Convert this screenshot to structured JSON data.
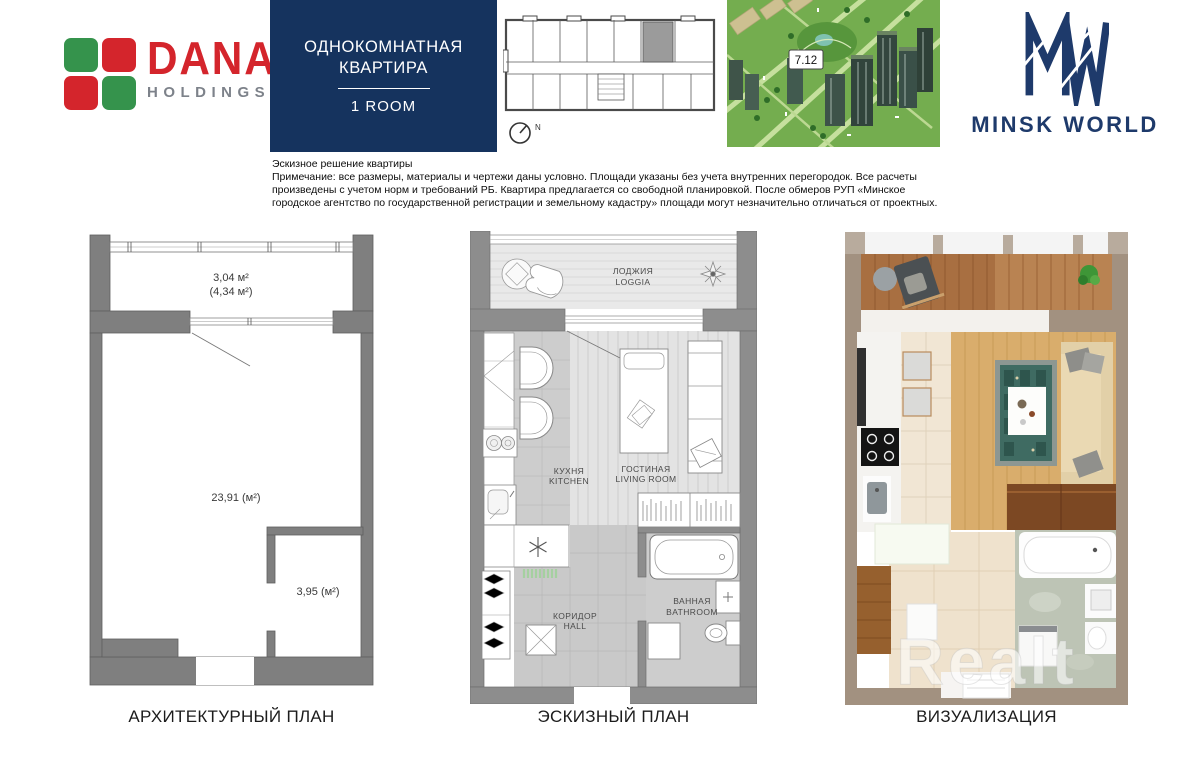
{
  "header": {
    "dana": {
      "name": "DANA",
      "subtitle": "HOLDINGS"
    },
    "title_box": {
      "line1": "ОДНОКОМНАТНАЯ",
      "line2": "КВАРТИРА",
      "room": "1 ROOM"
    },
    "compass_label": "N",
    "map_label": "7.12",
    "minsk_world": "MINSK WORLD"
  },
  "disclaimer": {
    "title": "Эскизное решение квартиры",
    "body": "Примечание: все размеры, материалы и чертежи даны условно. Площади указаны без учета внутренних перегородок. Все расчеты произведены с учетом норм и требований РБ. Квартира предлагается со свободной планировкой. После обмеров РУП «Минское городское агентство по государственной регистрации и земельному кадастру» площади могут незначительно отличаться от проектных."
  },
  "architectural_plan": {
    "loggia_area": "3,04 м²",
    "loggia_area_total": "(4,34 м²)",
    "main_room_area": "23,91 (м²)",
    "bathroom_area": "3,95 (м²)"
  },
  "sketch_plan": {
    "loggia_ru": "ЛОДЖИЯ",
    "loggia_en": "LOGGIA",
    "kitchen_ru": "КУХНЯ",
    "kitchen_en": "KITCHEN",
    "living_ru": "ГОСТИНАЯ",
    "living_en": "LIVING ROOM",
    "bathroom_ru": "ВАННАЯ",
    "bathroom_en": "BATHROOM",
    "hall_ru": "КОРИДОР",
    "hall_en": "HALL"
  },
  "visualization": {
    "watermark": "Realt"
  },
  "captions": {
    "architectural": "АРХИТЕКТУРНЫЙ ПЛАН",
    "sketch": "ЭСКИЗНЫЙ ПЛАН",
    "visualization": "ВИЗУАЛИЗАЦИЯ"
  },
  "colors": {
    "navy": "#15335e",
    "dana_red": "#d4252c",
    "dana_green": "#35934c",
    "arch_wall_gray": "#7f7f7f",
    "sketch_wall_gray": "#8d8d8d",
    "viz_wall_taupe": "#a29180",
    "viz_wood": "#b5794a",
    "viz_rug_teal": "#3f6b62",
    "map_green": "#74ad4f"
  }
}
